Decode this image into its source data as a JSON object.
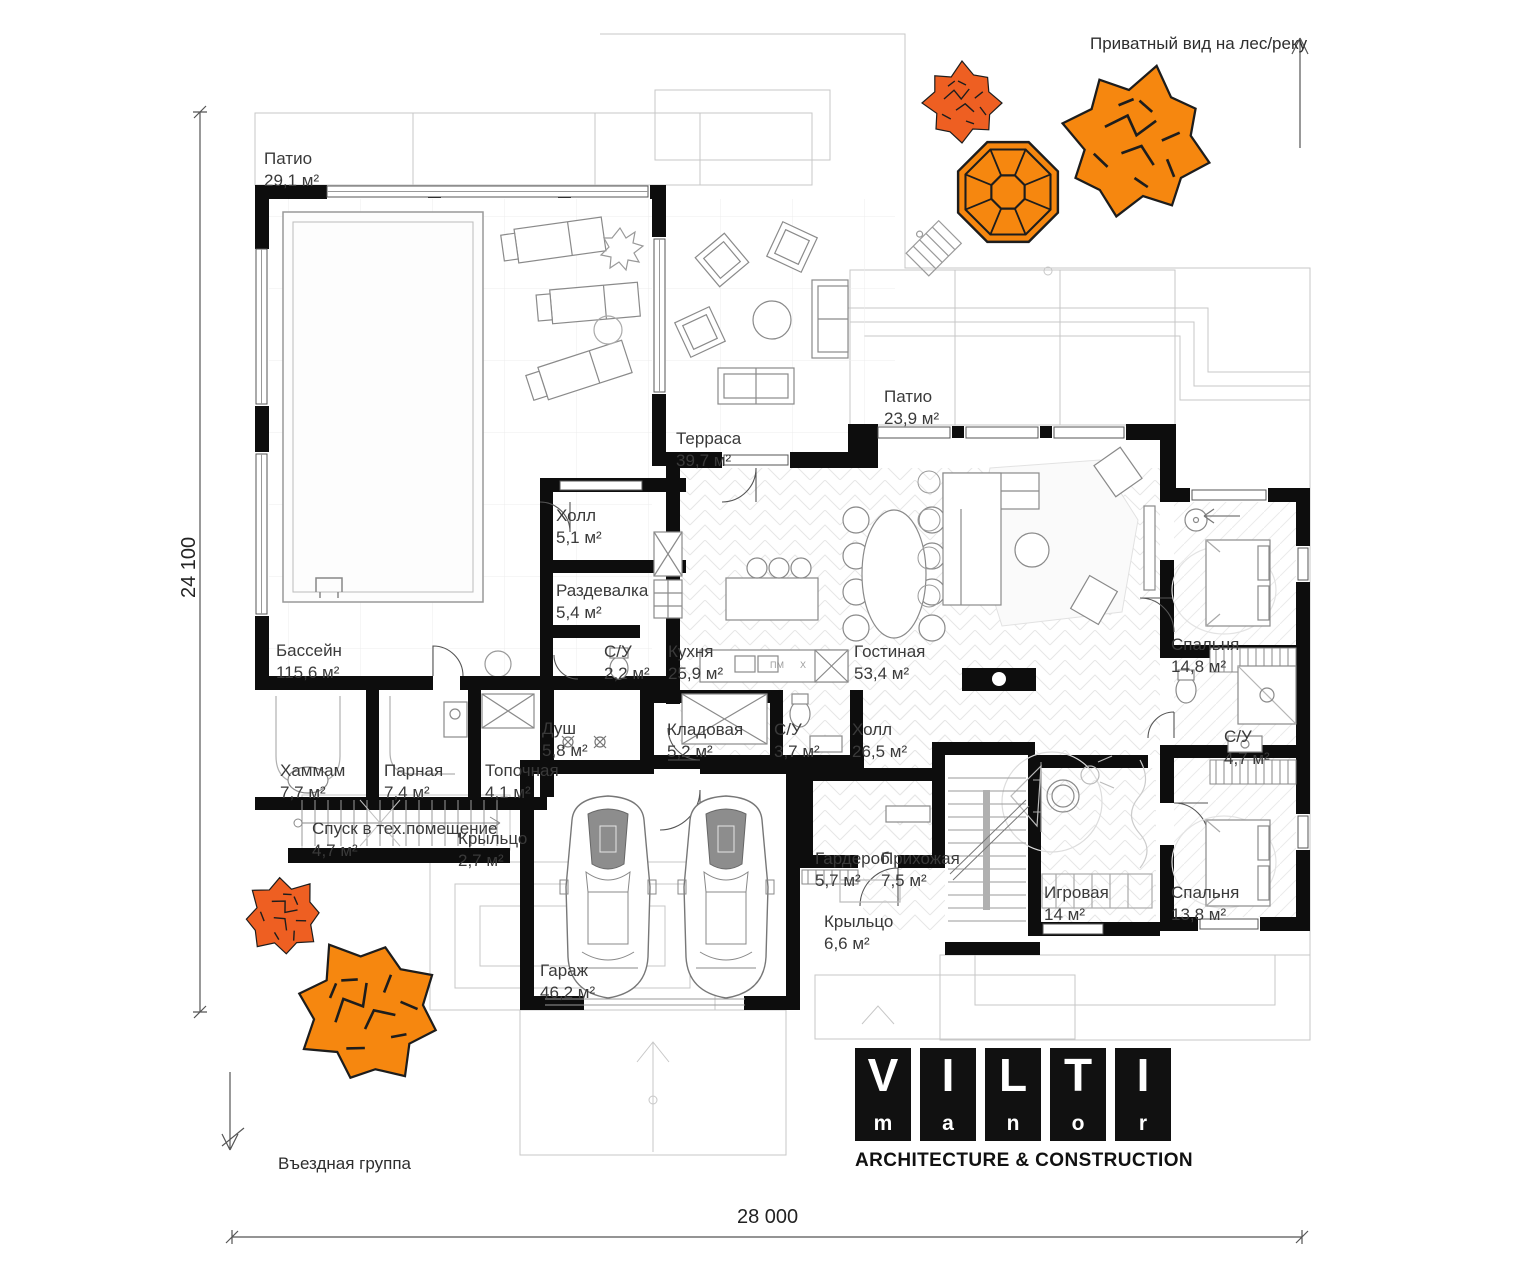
{
  "notes": {
    "top": "Приватный вид на лес/реку",
    "bottom": "Въездная группа"
  },
  "dimensions": {
    "width_label": "28 000",
    "height_label": "24 100"
  },
  "rooms": [
    {
      "name": "Патио",
      "area": "29,1 м²"
    },
    {
      "name": "Терраса",
      "area": "39,7 м²"
    },
    {
      "name": "Патио",
      "area": "23,9 м²"
    },
    {
      "name": "Холл",
      "area": "5,1 м²"
    },
    {
      "name": "Раздевалка",
      "area": "5,4 м²"
    },
    {
      "name": "Бассейн",
      "area": "115,6 м²"
    },
    {
      "name": "С/У",
      "area": "2,2 м²"
    },
    {
      "name": "Кухня",
      "area": "25,9 м²"
    },
    {
      "name": "Гостиная",
      "area": "53,4 м²"
    },
    {
      "name": "Спальня",
      "area": "14,8 м²"
    },
    {
      "name": "Хаммам",
      "area": "7,7 м²"
    },
    {
      "name": "Парная",
      "area": "7,4 м²"
    },
    {
      "name": "Топочная",
      "area": "4,1 м²"
    },
    {
      "name": "Душ",
      "area": "5,8 м²"
    },
    {
      "name": "Кладовая",
      "area": "5,2 м²"
    },
    {
      "name": "С/У",
      "area": "3,7 м²"
    },
    {
      "name": "Холл",
      "area": "26,5 м²"
    },
    {
      "name": "С/У",
      "area": "4,7 м²"
    },
    {
      "name": "Спуск в тех.помещение",
      "area": "4,7 м²"
    },
    {
      "name": "Крыльцо",
      "area": "2,7 м²"
    },
    {
      "name": "Гардероб",
      "area": "5,7 м²"
    },
    {
      "name": "Прихожая",
      "area": "7,5 м²"
    },
    {
      "name": "Игровая",
      "area": "14 м²"
    },
    {
      "name": "Спальня",
      "area": "13,8 м²"
    },
    {
      "name": "Крыльцо",
      "area": "6,6 м²"
    },
    {
      "name": "Гараж",
      "area": "46,2 м²"
    }
  ],
  "kitchen_appliance_labels": {
    "dishwasher": "ПМ",
    "hob": "X"
  },
  "logo": {
    "tiles": [
      {
        "big": "V",
        "small": "m"
      },
      {
        "big": "I",
        "small": "a"
      },
      {
        "big": "L",
        "small": "n"
      },
      {
        "big": "T",
        "small": "o"
      },
      {
        "big": "I",
        "small": "r"
      }
    ],
    "tagline": "ARCHITECTURE & CONSTRUCTION"
  },
  "colors": {
    "tree_primary": "#F6870F",
    "tree_secondary": "#EE5F22",
    "wall": "#0d0d0d",
    "logo_bg": "#111111"
  }
}
